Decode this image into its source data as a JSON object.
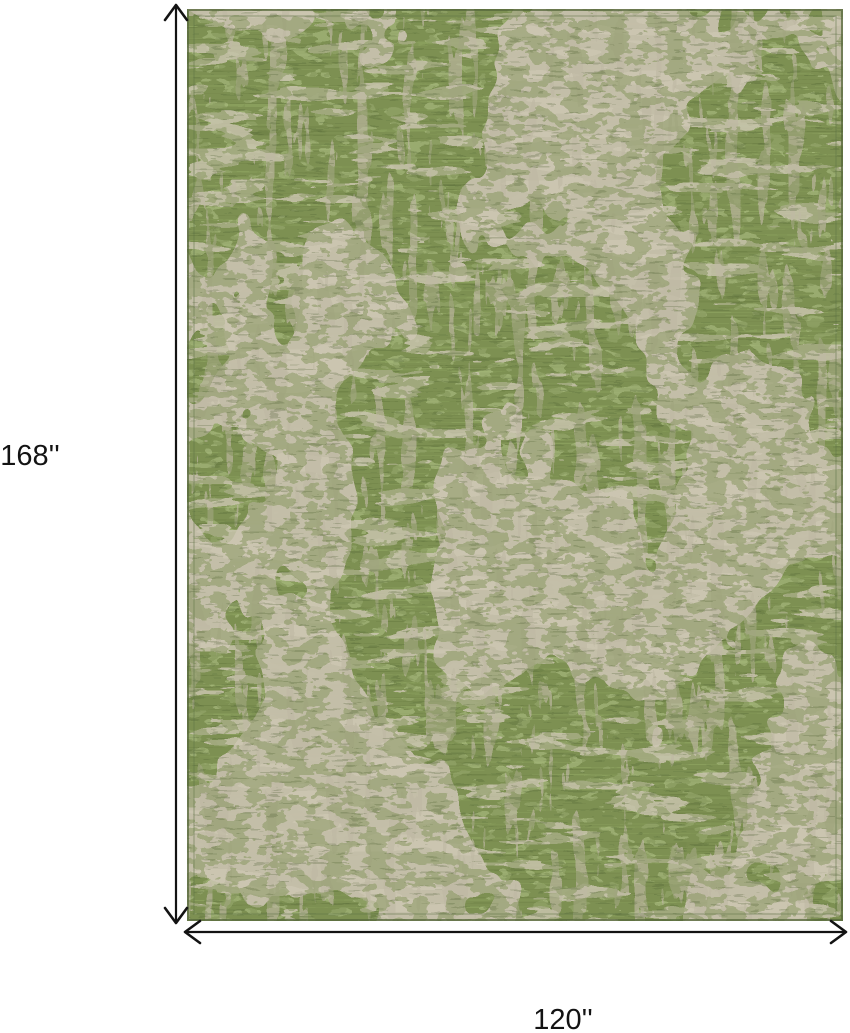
{
  "diagram": {
    "description": "Abstract distressed area rug shown with height and width dimension arrows",
    "height_label": "168''",
    "width_label": "120''",
    "height_value_inches": 168,
    "width_value_inches": 120,
    "annotation_color": "#131313",
    "background_color": "#ffffff",
    "rug_colors": {
      "green_base": "#7d9052",
      "green_dark_stria": "#66793f",
      "green_light_stria": "#9db46d",
      "green_light_speckle": "#b6c68c",
      "beige_patch": "#c6c0ab",
      "beige_light_dash": "#cdc7b3",
      "beige_dark_dash": "#bfb9a4",
      "green_distress": "#7d9052",
      "dark_accent": "#4d5f33",
      "border": "#57683c"
    }
  }
}
